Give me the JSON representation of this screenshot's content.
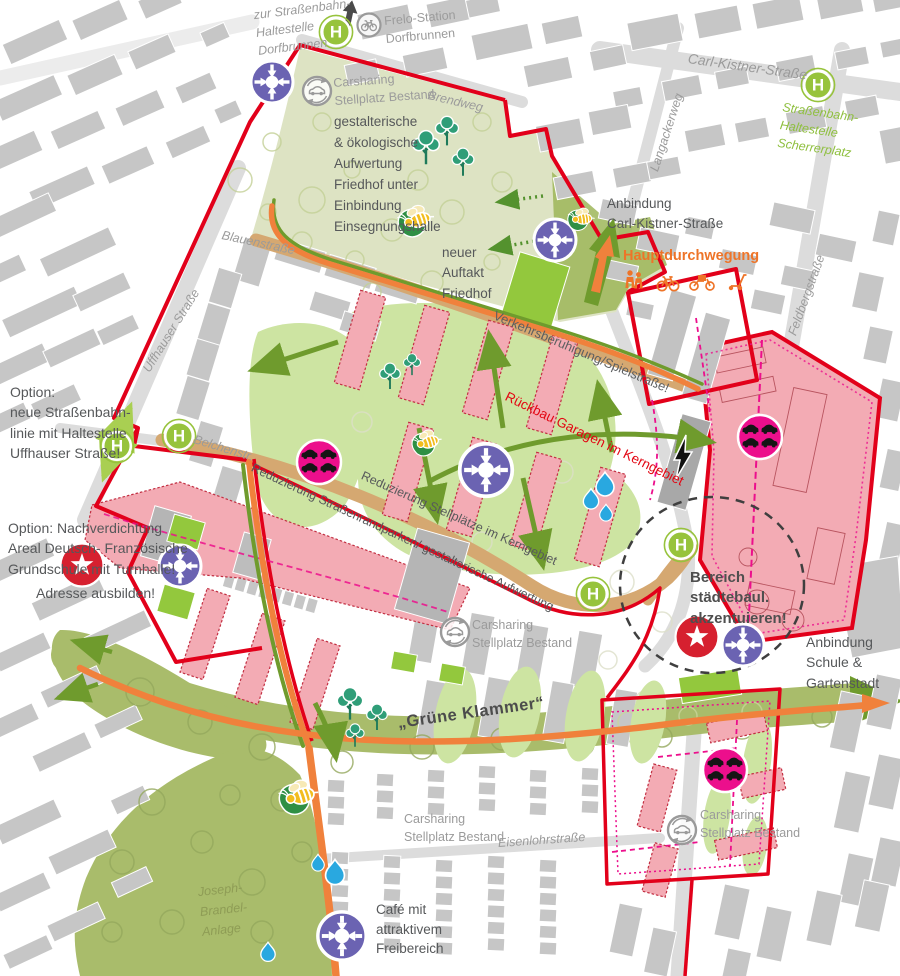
{
  "palette": {
    "building_gray": "#c6c6c6",
    "street_gray": "#dcdcdc",
    "cemetery_sage": "#dde3c3",
    "lawn_green": "#cde4a2",
    "bright_green": "#93c83d",
    "olive_band": "#a9bc6b",
    "arrow_green": "#6f9b2d",
    "light_green_arrow": "#a9cf52",
    "street_tan": "#d5a871",
    "path_orange": "#f0813c",
    "boundary_red": "#e2001a",
    "building_pink": "#f3abb4",
    "accent_magenta": "#ec0f8c",
    "hub_purple": "#6b63b2",
    "tree_teal": "#2f9e78",
    "water_blue": "#29a8e0"
  },
  "labels": {
    "zur_tram": "zur Straßenbahn-\nHaltestelle\nDorfbrunnen",
    "frelo": "Frelo-Station\nDorfbrunnen",
    "carsharing_top": "Carsharing\nStellplatz Bestand",
    "brendweg": "Brendweg",
    "carl_kistner": "Carl-Kistner-Straße",
    "langackerweg": "Langackerweg",
    "tram_scherrerplatz": "Straßenbahn-\nHaltestelle\nScherrerplatz",
    "feldbergstrasse": "Feldbergstraße",
    "friedhof": "gestalterische\n& ökologische\nAufwertung\nFriedhof unter\nEinbindung\nEinsegnungshalle",
    "blauenstrasse": "Blauenstraße",
    "uffhauser": "Uffhauser Straße",
    "auftakt": "neuer\nAuftakt\nFriedhof",
    "anbindung_ck": "Anbindung\nCarl-Kistner-Straße",
    "hauptdurchwegung": "Hauptdurchwegung",
    "verkehrsberuhigung": "Verkehrsberuhigung/Spielstraße!",
    "rueckbau": "Rückbau Garagen im Kerngebiet",
    "option_tram": "Option:\nneue Straßenbahn-\nlinie mit Haltestelle\nUffhauser Straße!",
    "belchenstr": "Belchenstr.",
    "red_strassenrand": "Reduzierung Straßenrandparken/ gestalterische Aufwertung",
    "red_stellplaetze": "Reduzierung Stellplätze im Kerngebiet",
    "option_schule": "Option: Nachverdichtung\nAreal Deutsch- Französische\nGrundschule mit Turnhalle!",
    "adresse": "Adresse ausbilden!",
    "bereich": "Bereich\nstädtebaul.\nakzentuieren!",
    "anbindung_schule": "Anbindung\nSchule &\nGartenstadt",
    "gruene_klammer": "„Grüne Klammer“",
    "carsharing_mid": "Carsharing\nStellplatz Bestand",
    "eisenlohr": "Eisenlohrstraße",
    "carsharing_bottom": "Carsharing\nStellplatz Bestand",
    "carsharing_br": "Carsharing\nStellplatz Bestand",
    "joseph": "Joseph-\nBrandel-\nAnlage",
    "cafe": "Café mit\nattraktivem\nFreibereich"
  },
  "icons": {
    "tram_stop": {
      "name": "tram-stop",
      "glyph": "H",
      "color": "#97c33c"
    },
    "mobility_hub": {
      "name": "mobility-hub",
      "color": "#6b63b2"
    },
    "parking_cars": {
      "name": "parking-cars",
      "color": "#ec0f8c"
    },
    "carsharing": {
      "name": "carsharing-car",
      "color": "#9a9a9a"
    },
    "frelo_bike": {
      "name": "frelo-bike",
      "color": "#9a9a9a"
    },
    "landmark_star": {
      "name": "landmark-star",
      "color": "#d6202f"
    },
    "bee": {
      "name": "bee-leaf",
      "color": "#f2bd1e"
    },
    "water_drop": {
      "name": "water-drop",
      "color": "#29a8e0"
    },
    "lightning": {
      "name": "lightning-bolt",
      "color": "#101010"
    },
    "tree": {
      "name": "tree",
      "color": "#2f9e78"
    },
    "hauptdurchwegung_modes": [
      "pedestrians",
      "bike",
      "cargo-bike",
      "scooter"
    ]
  }
}
